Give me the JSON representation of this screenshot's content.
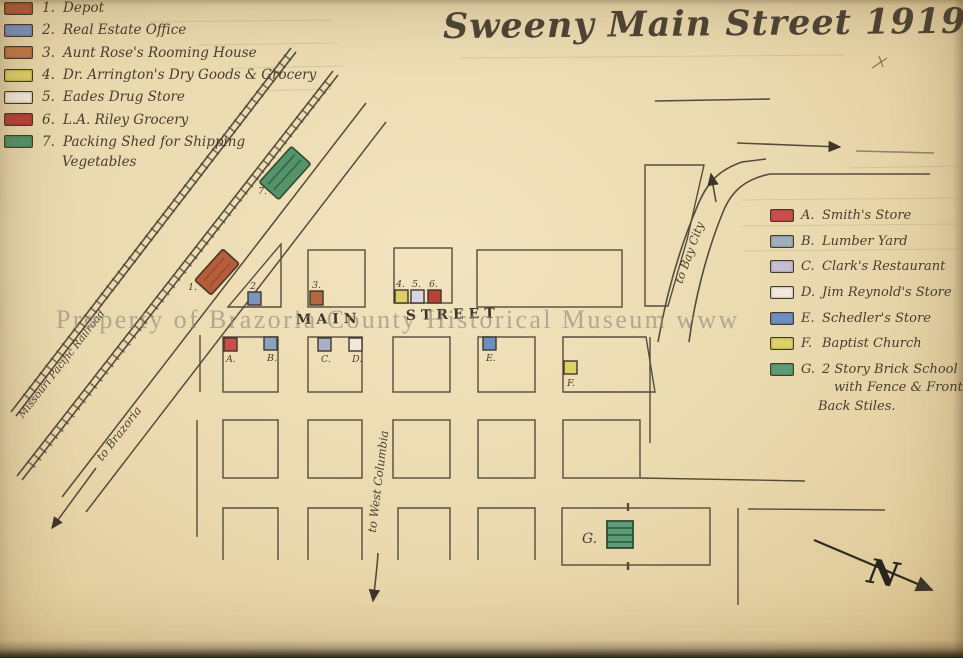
{
  "title": "Sweeny Main Street 1919",
  "watermark": "Property of Brazoria County Historical Museum www",
  "legend_left": {
    "items": [
      {
        "num": "1.",
        "label": "Depot",
        "color": "#b55c3a"
      },
      {
        "num": "2.",
        "label": "Real Estate Office",
        "color": "#7b93bd"
      },
      {
        "num": "3.",
        "label": "Aunt Rose's Rooming House",
        "color": "#c07a48"
      },
      {
        "num": "4.",
        "label": "Dr. Arrington's Dry Goods & Grocery",
        "color": "#ddcf66"
      },
      {
        "num": "5.",
        "label": "Eades Drug Store",
        "color": "#f1e8d4"
      },
      {
        "num": "6.",
        "label": "L.A. Riley Grocery",
        "color": "#b94236"
      },
      {
        "num": "7.",
        "label": "Packing Shed for Shipping",
        "color": "#55936a"
      }
    ],
    "item7_line2": "Vegetables"
  },
  "legend_right": {
    "items": [
      {
        "letter": "A.",
        "label": "Smith's Store",
        "color": "#c94f4a"
      },
      {
        "letter": "B.",
        "label": "Lumber Yard",
        "color": "#9fb0bb"
      },
      {
        "letter": "C.",
        "label": "Clark's Restaurant",
        "color": "#c5bfd3"
      },
      {
        "letter": "D.",
        "label": "Jim Reynold's Store",
        "color": "#f2e9dd"
      },
      {
        "letter": "E.",
        "label": "Schedler's Store",
        "color": "#6b8fc3"
      },
      {
        "letter": "F.",
        "label": "Baptist Church",
        "color": "#ded266"
      },
      {
        "letter": "G.",
        "label": "2 Story Brick School",
        "color": "#5d9c77"
      }
    ],
    "g_line2": "with Fence & Front a",
    "g_line3": "Back Stiles."
  },
  "map": {
    "street": {
      "word1": "MAIN",
      "word2": "STREET"
    },
    "railroad_label": "Missouri Pacific Railroad",
    "to_brazoria": "to Brazoria",
    "to_west_columbia": "to West Columbia",
    "to_bay_city": "to Bay City",
    "north_label": "N",
    "markers": {
      "m1": "1.",
      "m2": "2.",
      "m3": "3.",
      "m4": "4.",
      "m5": "5.",
      "m6": "6.",
      "m7": "7.",
      "ma": "A.",
      "mb": "B.",
      "mc": "C.",
      "md": "D.",
      "me": "E.",
      "mf": "F.",
      "mg": "G."
    },
    "marker_colors": {
      "m1": "#b55c3a",
      "m2": "#7b93bd",
      "m3": "#b06a3e",
      "m4": "#ddcf66",
      "m5": "#d9d3e6",
      "m6": "#b94236",
      "m7": "#55936a",
      "ma": "#c94f4a",
      "mb": "#8aa3c0",
      "mc": "#a8b0c8",
      "md": "#f0e8da",
      "me": "#6b8fc3",
      "mf": "#ded266",
      "mg": "#5d9c77"
    }
  },
  "colors": {
    "paper": "#e9d8ad",
    "ink": "#51483a"
  }
}
